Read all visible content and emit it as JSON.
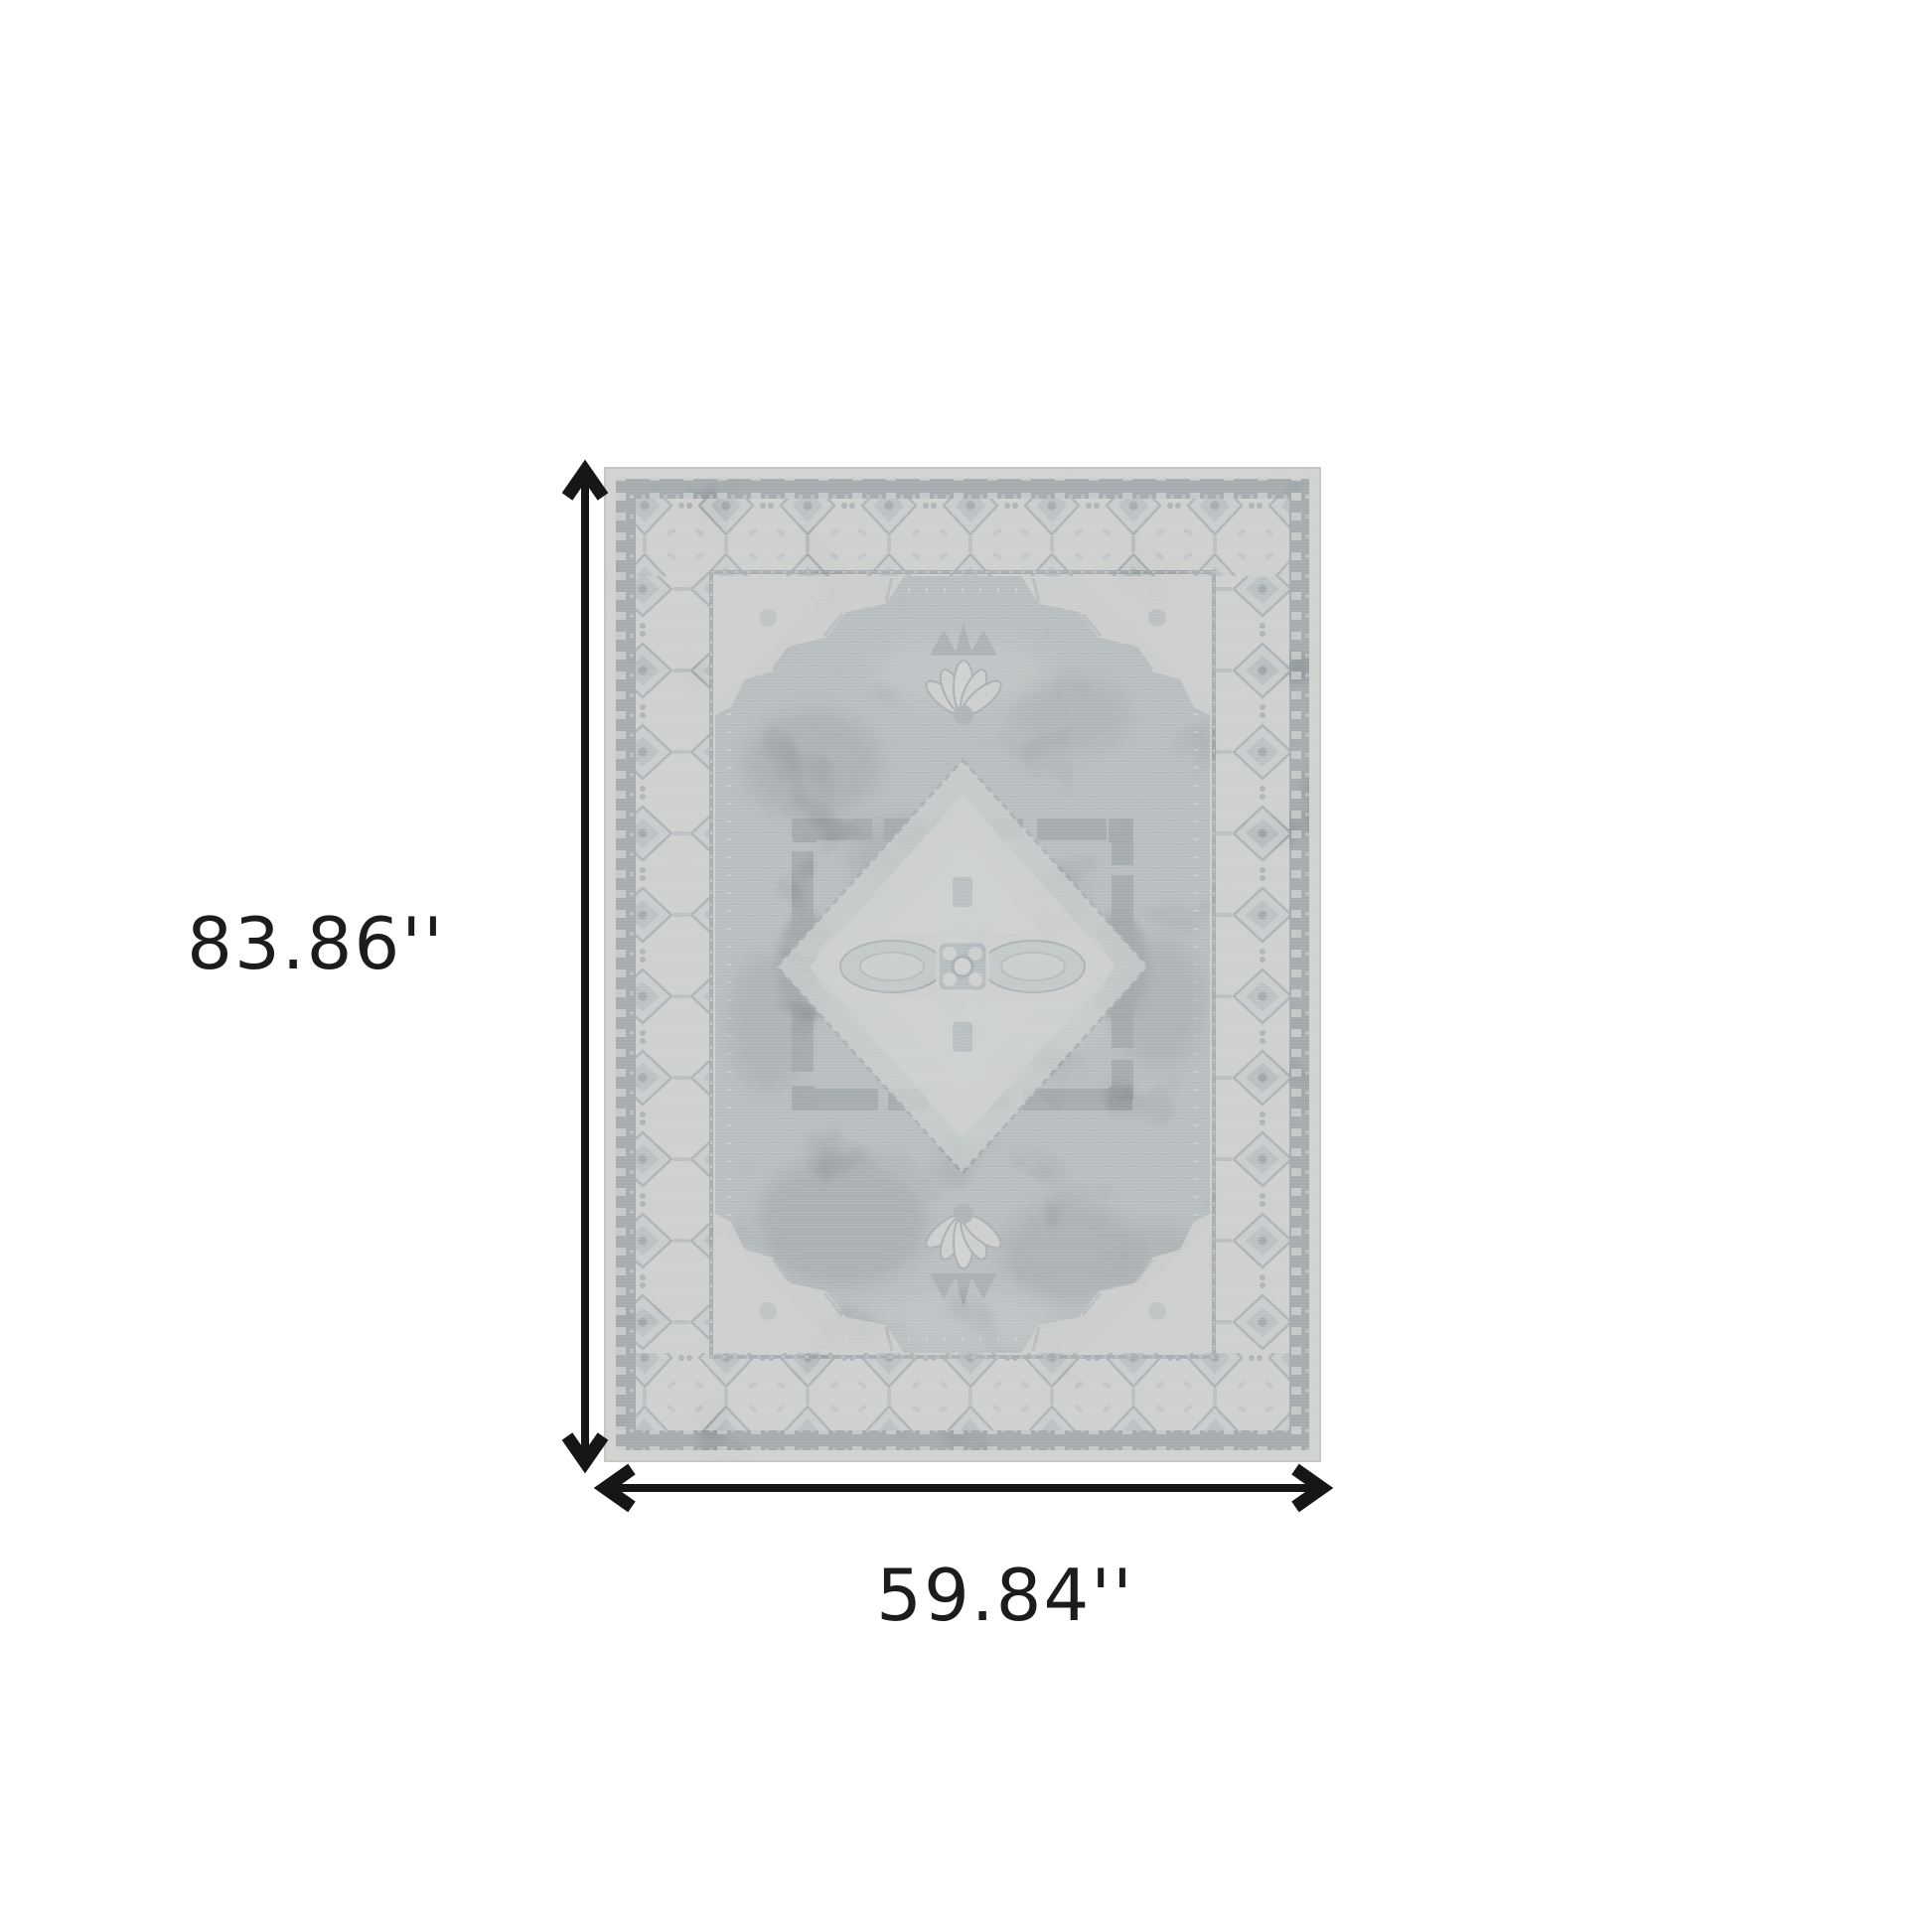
{
  "page": {
    "background_color": "#ffffff"
  },
  "diagram": {
    "height_label": "83.86''",
    "width_label": "59.84''",
    "arrow_color": "#161616",
    "label_color": "#1c1c1c"
  },
  "rug": {
    "colors": {
      "edge_cream": "#e0ded9",
      "outer_band_charcoal": "#4f5b63",
      "border_cream": "#d9d7d2",
      "field_slate": "#8e989d",
      "medallion_light": "#d7d9d5",
      "accent_charcoal": "#47525a",
      "detail_gray": "#6c7880"
    }
  }
}
